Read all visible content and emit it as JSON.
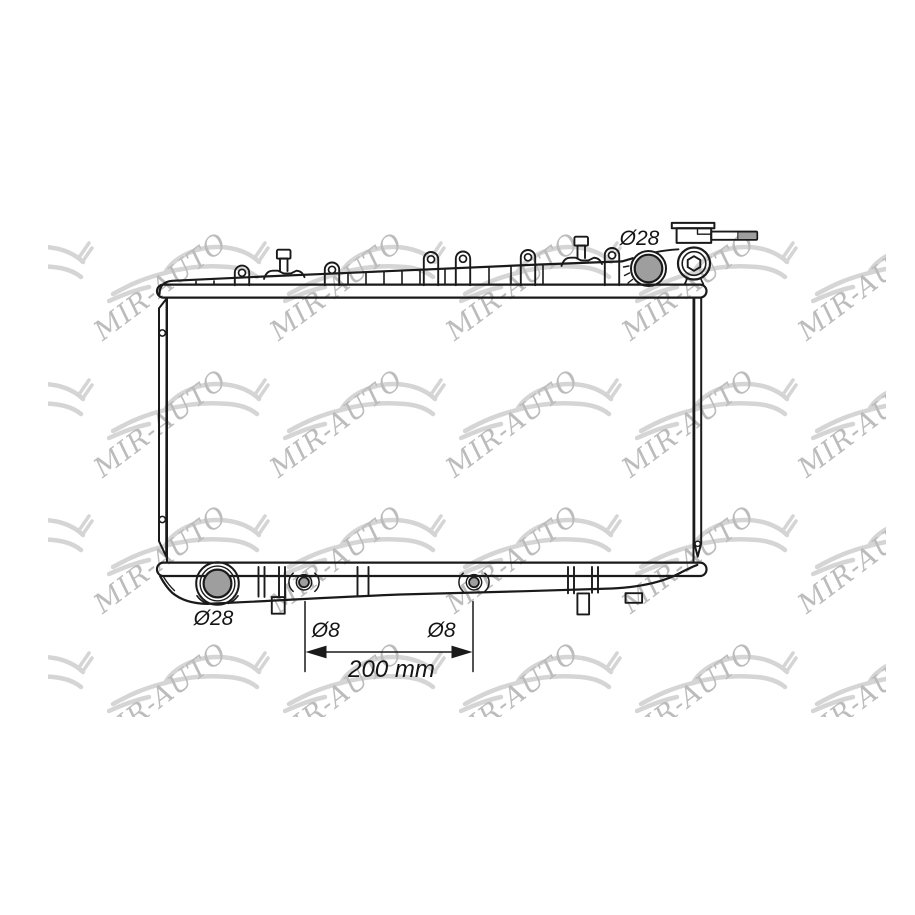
{
  "image": {
    "background_color": "#ffffff",
    "description": "technical line drawing of an automotive radiator"
  },
  "watermark": {
    "text": "MIR-AUTO",
    "text_color": "#bcbcbc",
    "car_color": "#d5d5d5"
  },
  "diagram": {
    "part_type": "radiator",
    "line_color": "#1a1a1a",
    "pipe_fill_color": "#9e9e9e",
    "labels": {
      "top_inlet_diameter": "Ø28",
      "bottom_outlet_diameter": "Ø28",
      "left_fitting_diameter": "Ø8",
      "right_fitting_diameter": "Ø8",
      "fitting_distance": "200 mm"
    }
  }
}
